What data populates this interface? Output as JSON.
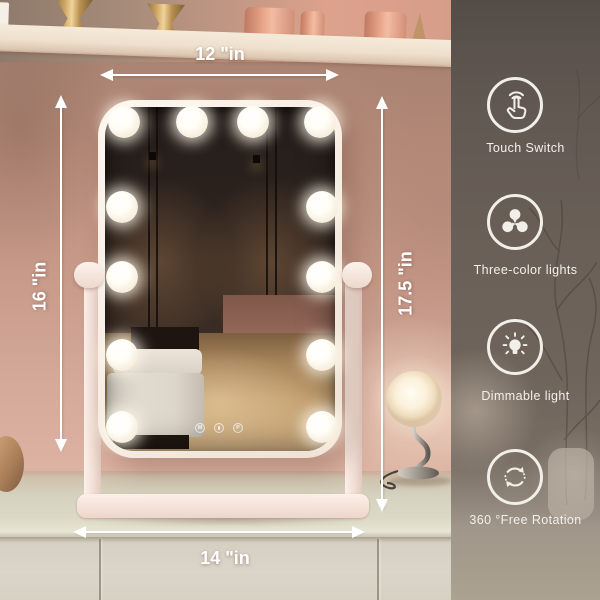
{
  "product_annotation": {
    "dimensions": {
      "top_width": "12 \"in",
      "left_height": "16 \"in",
      "right_height": "17.5 \"in",
      "bottom_width": "14 \"in"
    },
    "features": [
      {
        "icon": "touch-switch-icon",
        "label": "Touch Switch"
      },
      {
        "icon": "three-color-lights-icon",
        "label": "Three-color lights"
      },
      {
        "icon": "dimmable-light-icon",
        "label": "Dimmable light"
      },
      {
        "icon": "rotation-icon",
        "label": "360 °Free Rotation"
      }
    ],
    "mirror_controls": {
      "mode_button": "M",
      "power_icon": "power-icon",
      "preset_button": "P"
    },
    "bulb_count": 12,
    "colors": {
      "annotation_white": "#ffffff",
      "panel_overlay": "#6a6058",
      "wall_pink": "#c89a8a",
      "frame_white": "#f6ece2",
      "icon_white": "#f2efe9"
    }
  }
}
